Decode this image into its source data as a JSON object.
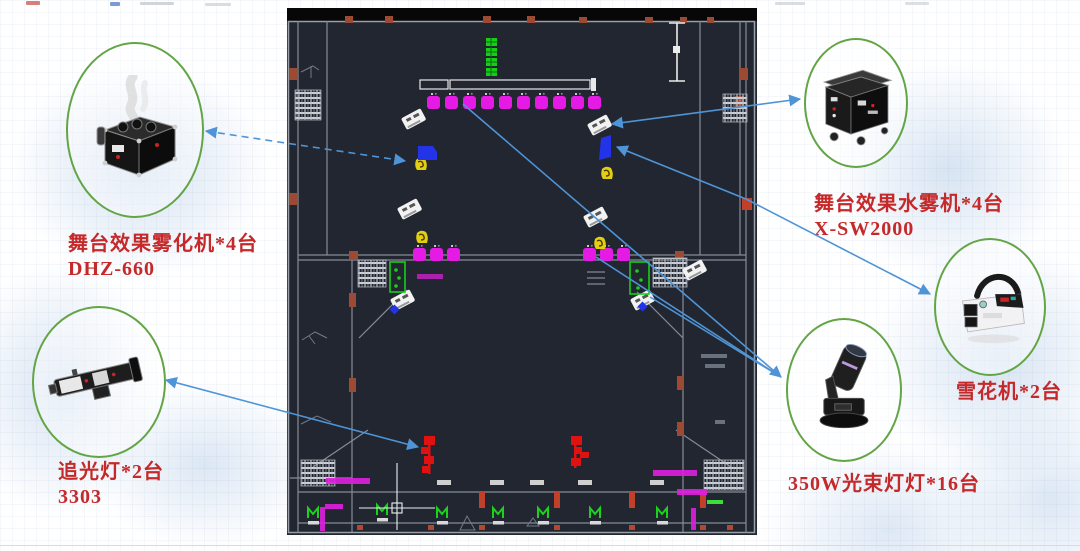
{
  "slide": {
    "background": "#ffffff",
    "watermark_color": "#a8c3e2",
    "label_color": "#c5292a",
    "arrow_color": "#4e94d6",
    "callout_ring_color": "#63a545"
  },
  "callouts": [
    {
      "id": "fog-machine",
      "line1": "舞台效果雾化机*4台",
      "line2": "DHZ-660",
      "image": "fog-machine-photo"
    },
    {
      "id": "water-mist-machine",
      "line1": "舞台效果水雾机*4台",
      "line2": "X-SW2000",
      "image": "water-mist-machine-photo"
    },
    {
      "id": "snow-machine",
      "line1": "雪花机*2台",
      "line2": "",
      "image": "snow-machine-photo"
    },
    {
      "id": "follow-spot",
      "line1": "追光灯*2台",
      "line2": "3303",
      "image": "follow-spot-photo"
    },
    {
      "id": "beam-light",
      "line1": "350W光束灯灯*16台",
      "line2": "",
      "image": "beam-light-photo"
    }
  ],
  "plan": {
    "name": "stage-lighting-cad-floor-plan",
    "background": "#212631",
    "wall_color": "#868c96",
    "markers": {
      "beam_light_marker": {
        "color": "#e51ae5",
        "count": 16
      },
      "fog_machine_marker": {
        "color": "#e3cf12",
        "count": 4
      },
      "water_mist_marker": {
        "color": "#f2f2f2",
        "count": 4
      },
      "snow_machine_marker": {
        "color": "#2233e8",
        "count": 2
      },
      "follow_spot_marker": {
        "color": "#e01111",
        "count": 2
      },
      "speaker_box": {
        "color": "#15cf15",
        "count": 2
      },
      "door_symbol": {
        "color": "#1dd21d",
        "count": 7
      }
    }
  }
}
